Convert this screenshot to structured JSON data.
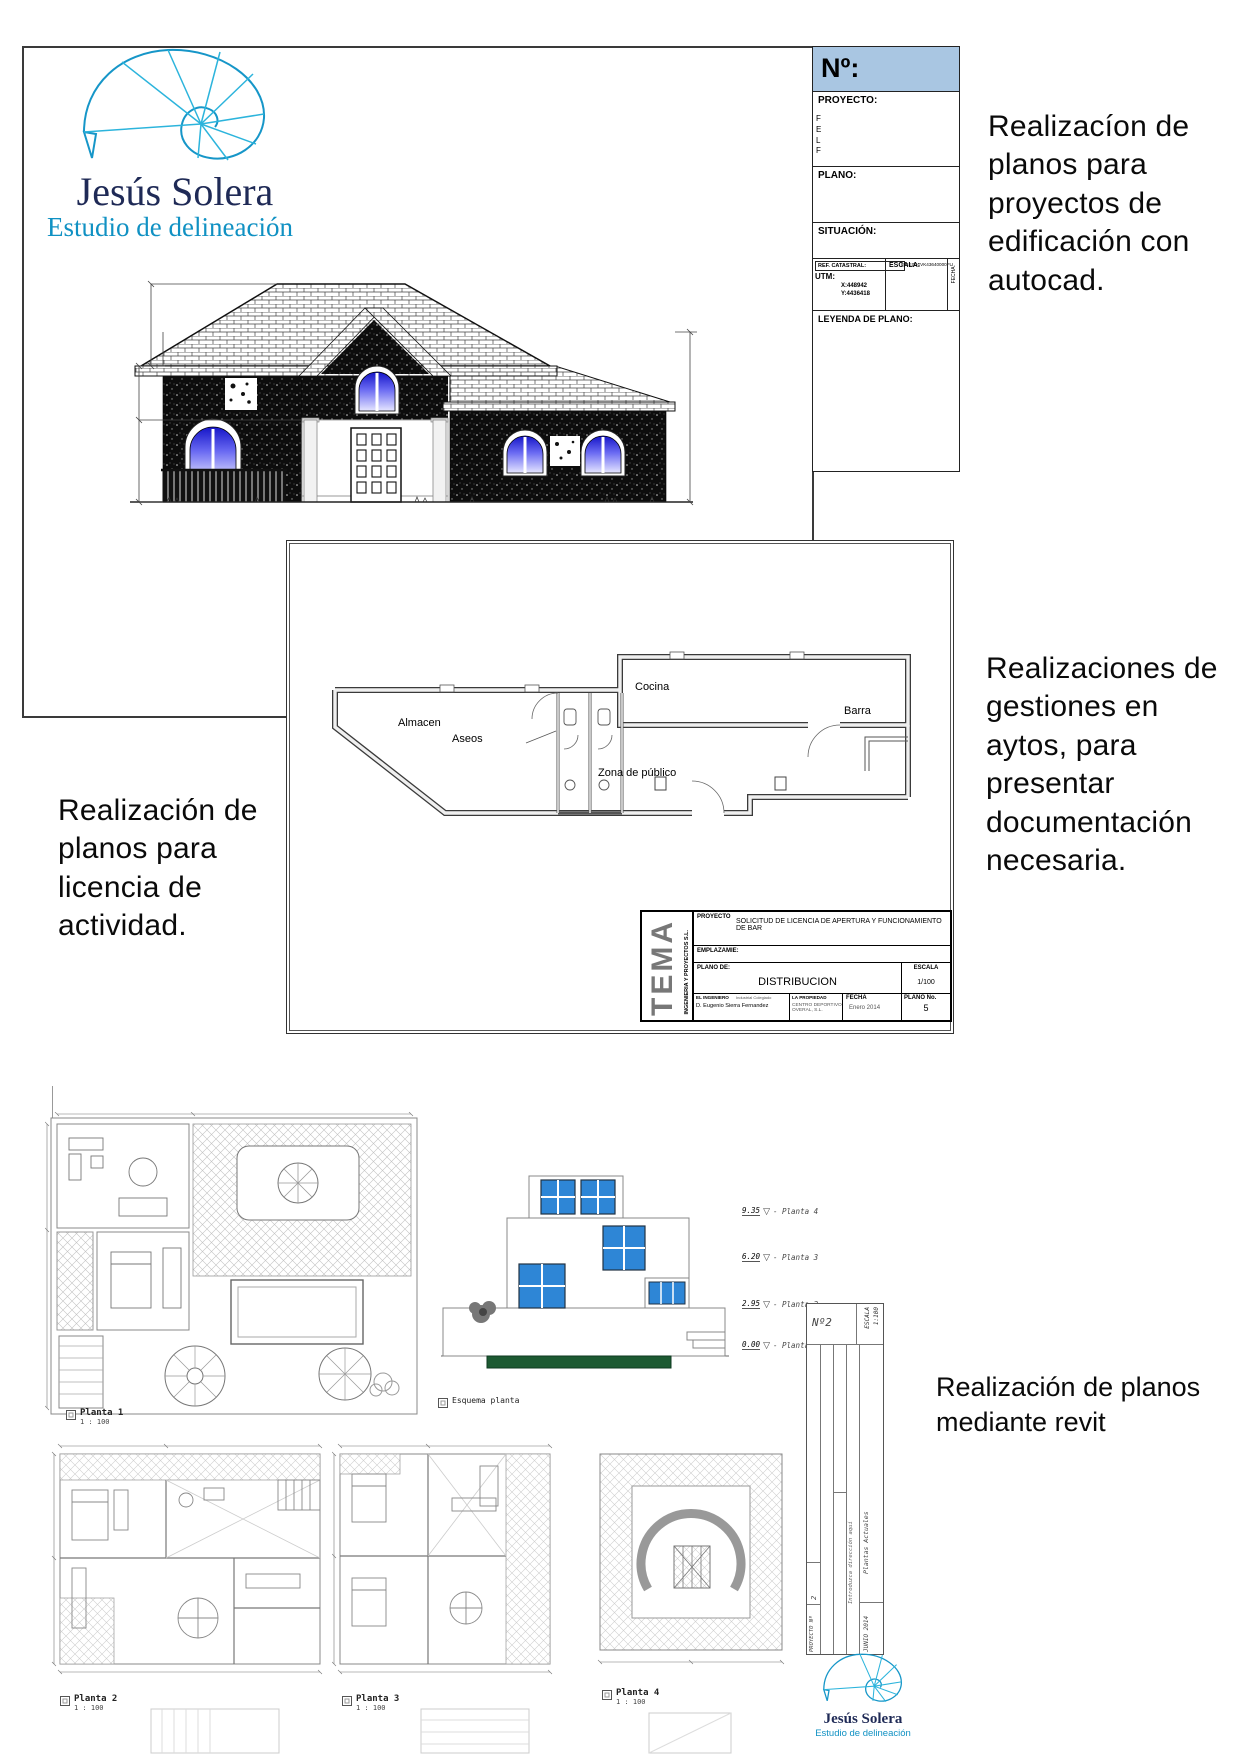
{
  "brand": {
    "name": "Jesús Solera",
    "tagline": "Estudio de delineación"
  },
  "captions": {
    "autocad": "Realizacíon de\nplanos para\nproyectos de\nedificación con\nautocad.",
    "licencia": "Realización de\nplanos para\nlicencia de\nactividad.",
    "gestiones": "Realizaciones de\ngestiones en\naytos, para\npresentar\ndocumentación\nnecesaria.",
    "revit": "Realización de planos\nmediante revit"
  },
  "tb1": {
    "numero": "Nº:",
    "proyecto": "PROYECTO:",
    "proyecto_side": "F\nE\nL\nF",
    "plano": "PLANO:",
    "situacion": "SITUACIÓN:",
    "ref_label": "REF. CATASTRAL:",
    "ref_value": "894E0D1VK43640000FU",
    "utm": "UTM:",
    "utm_x": "X:448942",
    "utm_y": "Y:4436418",
    "escala": "ESCALA:",
    "fecha": "FECHA:",
    "leyenda": "LEYENDA DE PLANO:"
  },
  "bar": {
    "almacen": "Almacen",
    "aseos": "Aseos",
    "cocina": "Cocina",
    "barra": "Barra",
    "zona": "Zona de público"
  },
  "tb2": {
    "logo": "TEMA",
    "logo_sub": "INGENIERIA Y PROYECTOS S.L.",
    "proyecto_label": "PROYECTO",
    "proyecto_value": "SOLICITUD DE LICENCIA DE APERTURA Y FUNCIONAMIENTO DE BAR",
    "emplazamiento_label": "EMPLAZAMIE:",
    "plano_label": "PLANO DE:",
    "plano_value": "DISTRIBUCION",
    "ingeniero_label": "EL INGENIERO",
    "ingeniero_sub": "Industrial Colegiado",
    "ingeniero_value": "D. Eugenio Sierra Fernandez",
    "propiedad_label": "LA PROPIEDAD",
    "propiedad_value": "CENTRO DEPORTIVO OVERAL, S.L.",
    "fecha_label": "FECHA",
    "fecha_value": "Enero 2014",
    "escala_label": "ESCALA",
    "escala_value": "1/100",
    "plano_no_label": "PLANO No.",
    "plano_no_value": "5"
  },
  "revit": {
    "levels": [
      {
        "elev": "9.35",
        "name": "Planta 4"
      },
      {
        "elev": "6.20",
        "name": "Planta 3"
      },
      {
        "elev": "2.95",
        "name": "Planta 2"
      },
      {
        "elev": "0.00",
        "name": "Planta 1"
      }
    ],
    "plans": [
      {
        "name": "Planta 1",
        "scale": "1 : 100"
      },
      {
        "name": "Planta 2",
        "scale": "1 : 100"
      },
      {
        "name": "Planta 3",
        "scale": "1 : 100"
      },
      {
        "name": "Planta 4",
        "scale": "1 : 100"
      }
    ],
    "esquema": "Esquema planta",
    "tb3": {
      "numero": "Nº2",
      "escala_label": "ESCALA",
      "escala_value": "1:100",
      "direccion": "Introduzca dirección aquí",
      "plantas": "Plantas Actuales",
      "proyecto_label": "PROYECTO Nº",
      "proyecto_value": "2",
      "fecha": "JUNIO 2014"
    }
  },
  "colors": {
    "accent_teal": "#1696c8",
    "brand_navy": "#1f2a56",
    "header_blue": "#a9c6e2",
    "window_blue": "#2e86d6",
    "hedge_green": "#1c5a32"
  }
}
